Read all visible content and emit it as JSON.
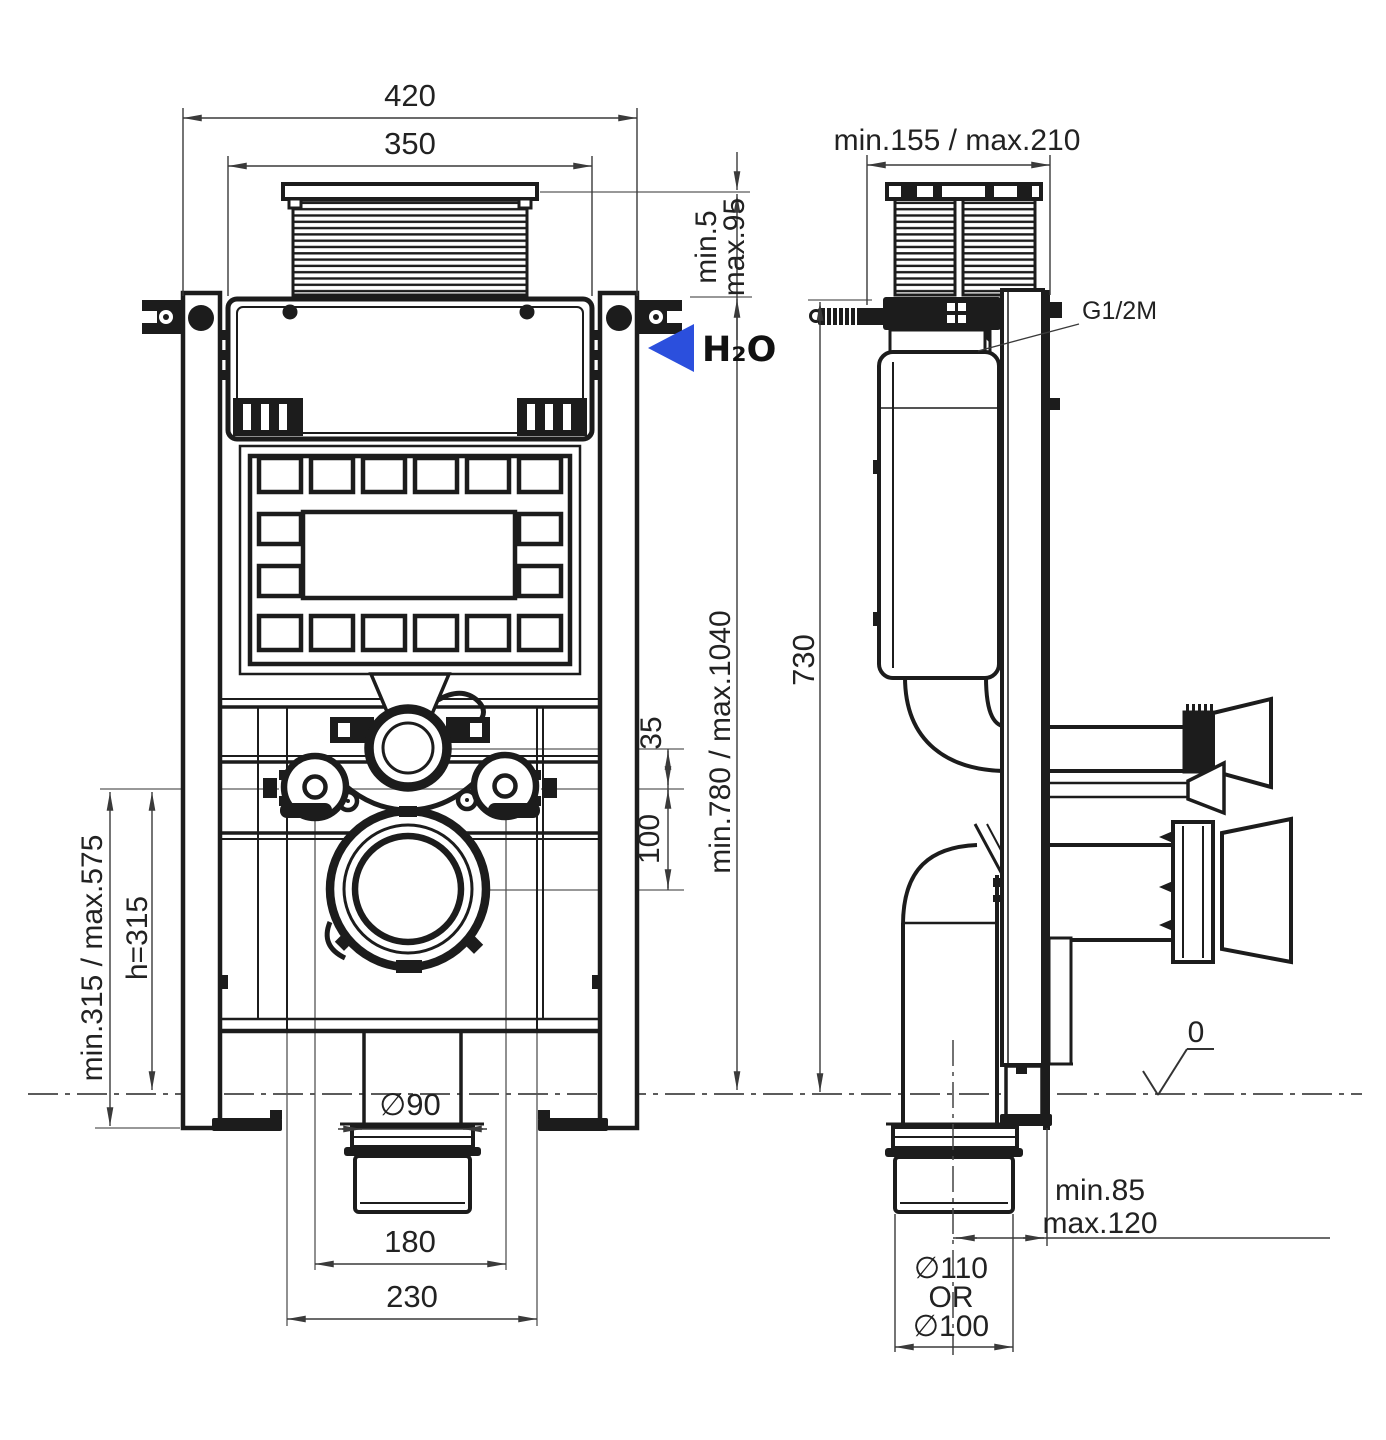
{
  "page": {
    "background": "#ffffff"
  },
  "colors": {
    "line": "#1c1c1c",
    "dim": "#3a3a3a",
    "ext": "#8a8a8a",
    "accent_blue": "#2b4fdd"
  },
  "front_view": {
    "dims": {
      "overall_width": "420",
      "cistern_width": "350",
      "shaft_min": "min.5",
      "shaft_max": "max.95",
      "height_range": "min.780 / max.1040",
      "flush_offset": "35",
      "waste_offset": "100",
      "bolt_height_range": "min.315 / max.575",
      "bolt_height": "h=315",
      "outlet_diameter": "∅90",
      "bolt_spacing": "180",
      "channel_spacing": "230"
    },
    "water_label": "H₂O"
  },
  "side_view": {
    "dims": {
      "depth_range": "min.155 / max.210",
      "frame_height": "730",
      "wall_offset_min": "min.85",
      "wall_offset_max": "max.120",
      "outlet_d1": "∅110",
      "outlet_or": "OR",
      "outlet_d2": "∅100",
      "floor_level": "0"
    },
    "inlet_label": "G1/2M"
  }
}
